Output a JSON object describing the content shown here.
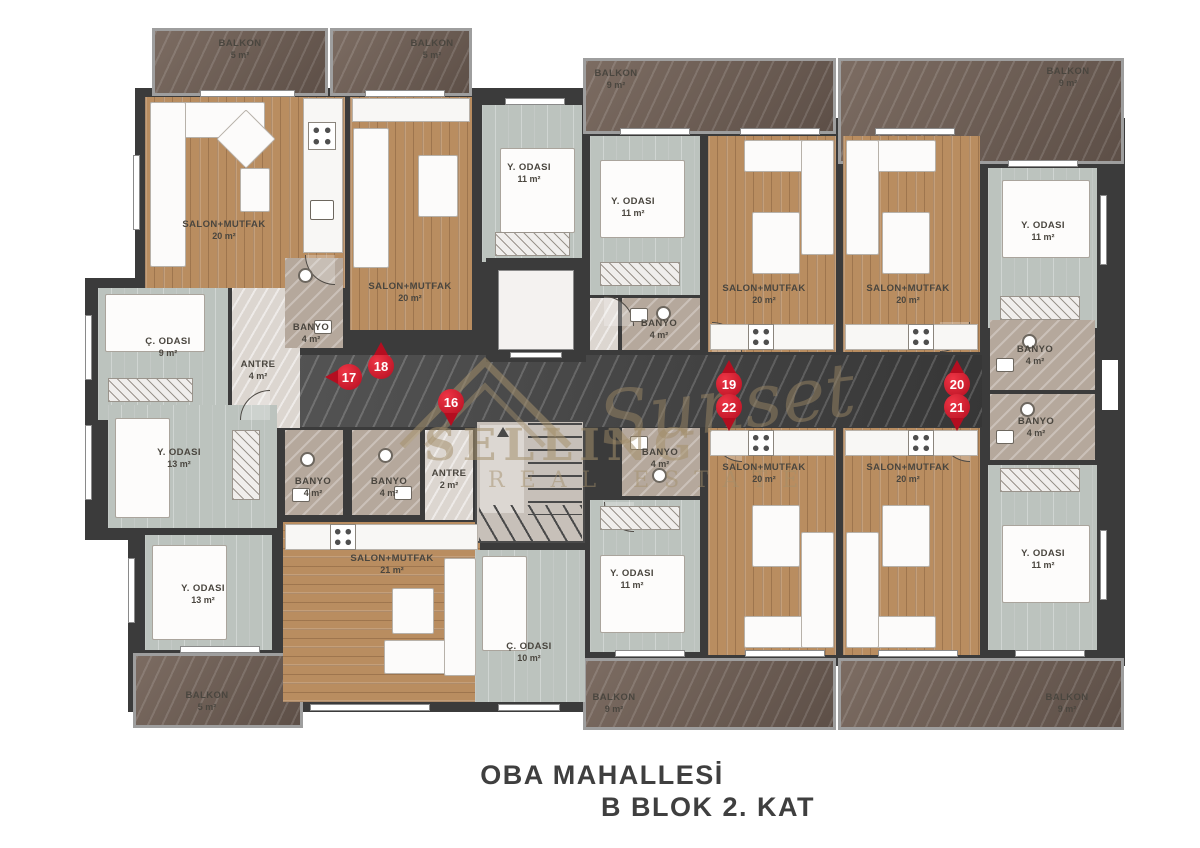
{
  "title": {
    "line1": "OBA MAHALLESİ",
    "line2": "B BLOK 2. KAT"
  },
  "watermark": {
    "brand_top": "SELLING",
    "brand_script": "Sunset",
    "brand_bottom": "REAL ESTATE"
  },
  "markers": [
    {
      "number": "16",
      "direction": "down"
    },
    {
      "number": "17",
      "direction": "left"
    },
    {
      "number": "18",
      "direction": "up"
    },
    {
      "number": "19",
      "direction": "up"
    },
    {
      "number": "22",
      "direction": "down"
    },
    {
      "number": "20",
      "direction": "up"
    },
    {
      "number": "21",
      "direction": "down"
    }
  ],
  "rooms": [
    {
      "name": "SALON+MUTFAK",
      "area": "20 m²"
    },
    {
      "name": "SALON+MUTFAK",
      "area": "20 m²"
    },
    {
      "name": "BALKON",
      "area": "5 m²"
    },
    {
      "name": "BALKON",
      "area": "5 m²"
    },
    {
      "name": "Y. ODASI",
      "area": "11 m²"
    },
    {
      "name": "Ç. ODASI",
      "area": "9 m²"
    },
    {
      "name": "ANTRE",
      "area": "4 m²"
    },
    {
      "name": "BANYO",
      "area": "4 m²"
    },
    {
      "name": "Y. ODASI",
      "area": "13 m²"
    },
    {
      "name": "Y. ODASI",
      "area": "13 m²"
    },
    {
      "name": "BANYO",
      "area": "4 m²"
    },
    {
      "name": "BANYO",
      "area": "4 m²"
    },
    {
      "name": "ANTRE",
      "area": "2 m²"
    },
    {
      "name": "SALON+MUTFAK",
      "area": "21 m²"
    },
    {
      "name": "Ç. ODASI",
      "area": "10 m²"
    },
    {
      "name": "BALKON",
      "area": "5 m²"
    },
    {
      "name": "BALKON",
      "area": "9 m²"
    },
    {
      "name": "BALKON",
      "area": "9 m²"
    },
    {
      "name": "Y. ODASI",
      "area": "11 m²"
    },
    {
      "name": "SALON+MUTFAK",
      "area": "20 m²"
    },
    {
      "name": "SALON+MUTFAK",
      "area": "20 m²"
    },
    {
      "name": "Y. ODASI",
      "area": "11 m²"
    },
    {
      "name": "BANYO",
      "area": "4 m²"
    },
    {
      "name": "BANYO",
      "area": "4 m²"
    },
    {
      "name": "BANYO",
      "area": "4 m²"
    },
    {
      "name": "BANYO",
      "area": "4 m²"
    },
    {
      "name": "SALON+MUTFAK",
      "area": "20 m²"
    },
    {
      "name": "SALON+MUTFAK",
      "area": "20 m²"
    },
    {
      "name": "Y. ODASI",
      "area": "11 m²"
    },
    {
      "name": "Y. ODASI",
      "area": "11 m²"
    },
    {
      "name": "BALKON",
      "area": "9 m²"
    },
    {
      "name": "BALKON",
      "area": "9 m²"
    }
  ],
  "palette": {
    "marker_red": "#b40e20",
    "wall": "#3b3b3b",
    "wood_floor": "#b98d60",
    "bedroom_floor": "#bcc3be",
    "bath_marble": "#b5a89c",
    "balcony_marble": "#6e5f56",
    "corridor_marble": "#9c9083",
    "title_text": "#3f3f3f",
    "watermark_gold": "#a8946f"
  }
}
